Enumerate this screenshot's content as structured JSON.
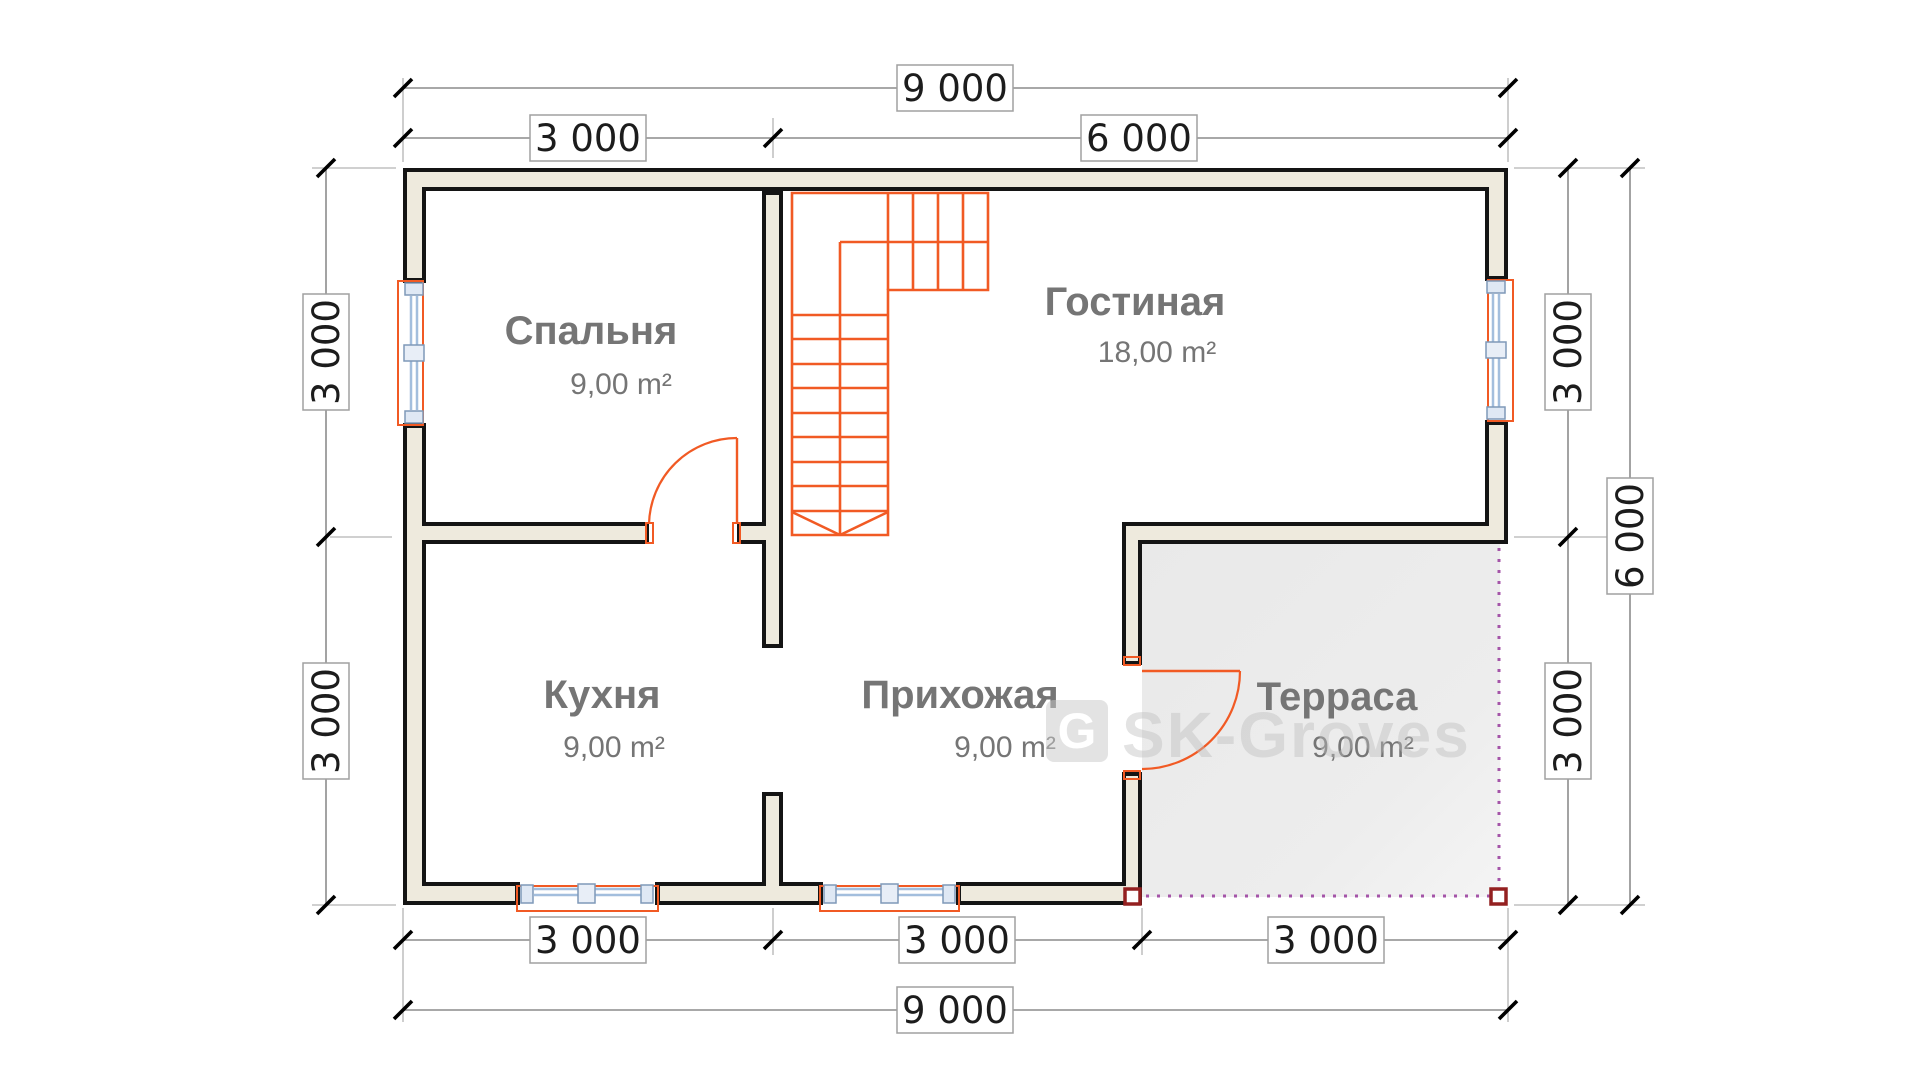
{
  "plan": {
    "rooms": [
      {
        "id": "bedroom",
        "name": "Спальня",
        "area": "9,00 m²"
      },
      {
        "id": "living",
        "name": "Гостиная",
        "area": "18,00 m²"
      },
      {
        "id": "kitchen",
        "name": "Кухня",
        "area": "9,00 m²"
      },
      {
        "id": "hall",
        "name": "Прихожая",
        "area": "9,00 m²"
      },
      {
        "id": "terrace",
        "name": "Терраса",
        "area": "9,00 m²"
      }
    ],
    "dimensions": {
      "top_total": "9 000",
      "top_left": "3 000",
      "top_right": "6 000",
      "bottom_1": "3 000",
      "bottom_2": "3 000",
      "bottom_3": "3 000",
      "bottom_total": "9 000",
      "left_top": "3 000",
      "left_bottom": "3 000",
      "right_top": "3 000",
      "right_bottom": "3 000",
      "right_total": "6 000"
    },
    "watermark": {
      "text": "SK-Groves",
      "logo_letter": "G"
    },
    "colors": {
      "wall_outline": "#141414",
      "wall_fill": "#eeeadd",
      "stair_and_doors": "#f15a24",
      "window_frame": "#a3bedd",
      "terrace_fill": "#ebebeb",
      "terrace_edge": "#a454a8",
      "corner_post": "#942020",
      "room_label": "#757575",
      "dimension_line": "#8c8c8c"
    }
  }
}
